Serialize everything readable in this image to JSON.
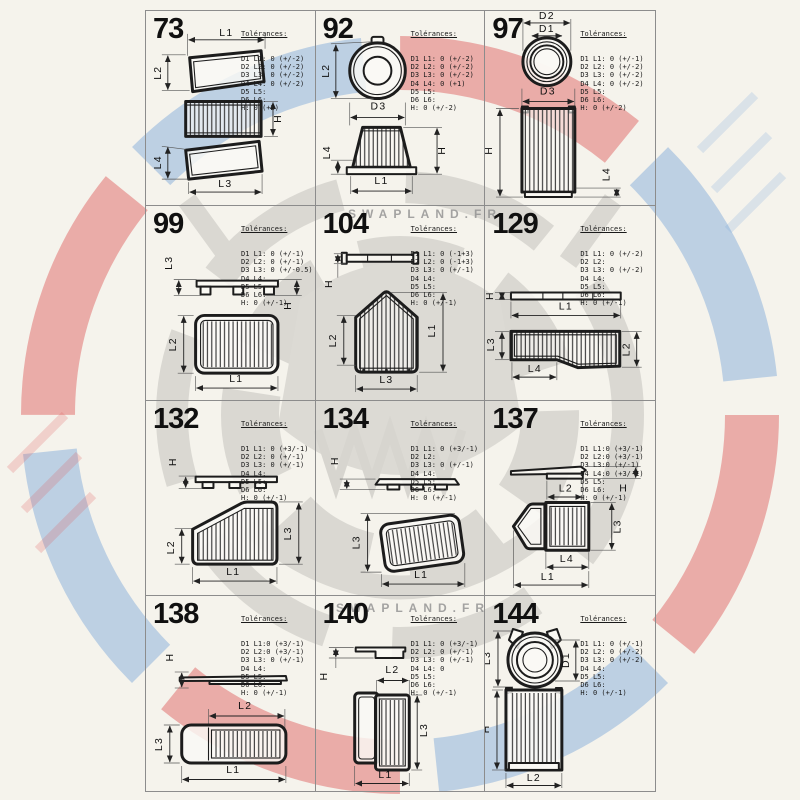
{
  "page": {
    "background": "#f5f3ec",
    "grid_line_color": "#8c8c8c",
    "ink_color": "#1c1c1c",
    "watermark_red": "#de5757",
    "watermark_blue": "#79a7d9"
  },
  "watermark": {
    "text": "SWAPLAND.FR"
  },
  "tol_title": "Tolérances:",
  "cells": [
    {
      "number": "73",
      "tol": [
        "D1 L1: 0 (+/-2)",
        "D2 L2: 0 (+/-2)",
        "D3 L3: 0 (+/-2)",
        "D4 L4: 0 (+/-2)",
        "D5 L5:",
        "D6 L6:",
        "H: 0 (+2)"
      ],
      "dims": {
        "l1": "L1",
        "l2": "L2",
        "l3": "L3",
        "l4": "L4",
        "h": "H"
      }
    },
    {
      "number": "92",
      "tol": [
        "D1 L1: 0 (+/-2)",
        "D2 L2: 0 (+/-2)",
        "D3 L3: 0 (+/-2)",
        "D4 L4: 0 (+1)",
        "D5 L5:",
        "D6 L6:",
        "H: 0 (+/-2)"
      ],
      "dims": {
        "l1": "L1",
        "l2": "L2",
        "l4": "L4",
        "d3": "D3",
        "h": "H"
      }
    },
    {
      "number": "97",
      "tol": [
        "D1 L1: 0 (+/-1)",
        "D2 L2: 0 (+/-2)",
        "D3 L3: 0 (+/-2)",
        "D4 L4: 0 (+/-2)",
        "D5 L5:",
        "D6 L6:",
        "H: 0 (+/-2)"
      ],
      "dims": {
        "d1": "D1",
        "d2": "D2",
        "d3": "D3",
        "l4": "L4",
        "h": "H"
      }
    },
    {
      "number": "99",
      "tol": [
        "D1 L1: 0 (+/-1)",
        "D2 L2: 0 (+/-1)",
        "D3 L3: 0 (+/-0.5)",
        "D4 L4:",
        "D5 L5:",
        "D6 L6:",
        "H: 0 (+/-1)"
      ],
      "dims": {
        "l1": "L1",
        "l2": "L2",
        "l3": "L3",
        "h": "H"
      }
    },
    {
      "number": "104",
      "tol": [
        "D1 L1: 0 (-1+3)",
        "D2 L2: 0 (-1+3)",
        "D3 L3: 0 (+/-1)",
        "D4 L4:",
        "D5 L5:",
        "D6 L6:",
        "H: 0 (+/-1)"
      ],
      "dims": {
        "l1": "L1",
        "l2": "L2",
        "l3": "L3",
        "h": "H"
      }
    },
    {
      "number": "129",
      "tol": [
        "D1 L1: 0 (+/-2)",
        "D2 L2:",
        "D3 L3: 0 (+/-2)",
        "D4 L4:",
        "D5 L5:",
        "D6 L6:",
        "H: 0 (+/-1)"
      ],
      "dims": {
        "l1": "L1",
        "l2": "L2",
        "l3": "L3",
        "l4": "L4",
        "h": "H"
      }
    },
    {
      "number": "132",
      "tol": [
        "D1 L1: 0 (+3/-1)",
        "D2 L2: 0 (+/-1)",
        "D3 L3: 0 (+/-1)",
        "D4 L4:",
        "D5 L5:",
        "D6 L6:",
        "H: 0 (+/-1)"
      ],
      "dims": {
        "l1": "L1",
        "l2": "L2",
        "l3": "L3",
        "h": "H"
      }
    },
    {
      "number": "134",
      "tol": [
        "D1 L1: 0 (+3/-1)",
        "D2 L2:",
        "D3 L3: 0 (+/-1)",
        "D4 L4:",
        "D5 L5:",
        "D6 L6:",
        "H: 0 (+/-1)"
      ],
      "dims": {
        "l1": "L1",
        "l3": "L3",
        "h": "H"
      }
    },
    {
      "number": "137",
      "tol": [
        "D1 L1:0 (+3/-1)",
        "D2 L2:0 (+3/-1)",
        "D3 L3:0 (+/-1)",
        "D4 L4:0 (+3/-1)",
        "D5 L5:",
        "D6 L6:",
        "H: 0 (+/-1)"
      ],
      "dims": {
        "l1": "L1",
        "l2": "L2",
        "l3": "L3",
        "l4": "L4",
        "h": "H"
      }
    },
    {
      "number": "138",
      "tol": [
        "D1 L1:0 (+3/-1)",
        "D2 L2:0 (+3/-1)",
        "D3 L3: 0 (+/-1)",
        "D4 L4:",
        "D5 L5:",
        "D6 L6:",
        "H: 0 (+/-1)"
      ],
      "dims": {
        "l1": "L1",
        "l2": "L2",
        "l3": "L3",
        "h": "H"
      }
    },
    {
      "number": "140",
      "tol": [
        "D1 L1: 0 (+3/-1)",
        "D2 L2: 0 (+/-1)",
        "D3 L3: 0 (+/-1)",
        "D4 L4: 0",
        "D5 L5:",
        "D6 L6:",
        "H: 0 (+/-1)"
      ],
      "dims": {
        "l1": "L1",
        "l2": "L2",
        "l3": "L3",
        "h": "H"
      }
    },
    {
      "number": "144",
      "tol": [
        "D1 L1: 0 (+/-1)",
        "D2 L2: 0 (+/-2)",
        "D3 L3: 0 (+/-2)",
        "D4 L4:",
        "D5 L5:",
        "D6 L6:",
        "H: 0 (+/-1)"
      ],
      "dims": {
        "l2": "L2",
        "l3": "L3",
        "d1": "D1",
        "h": "H"
      }
    }
  ]
}
